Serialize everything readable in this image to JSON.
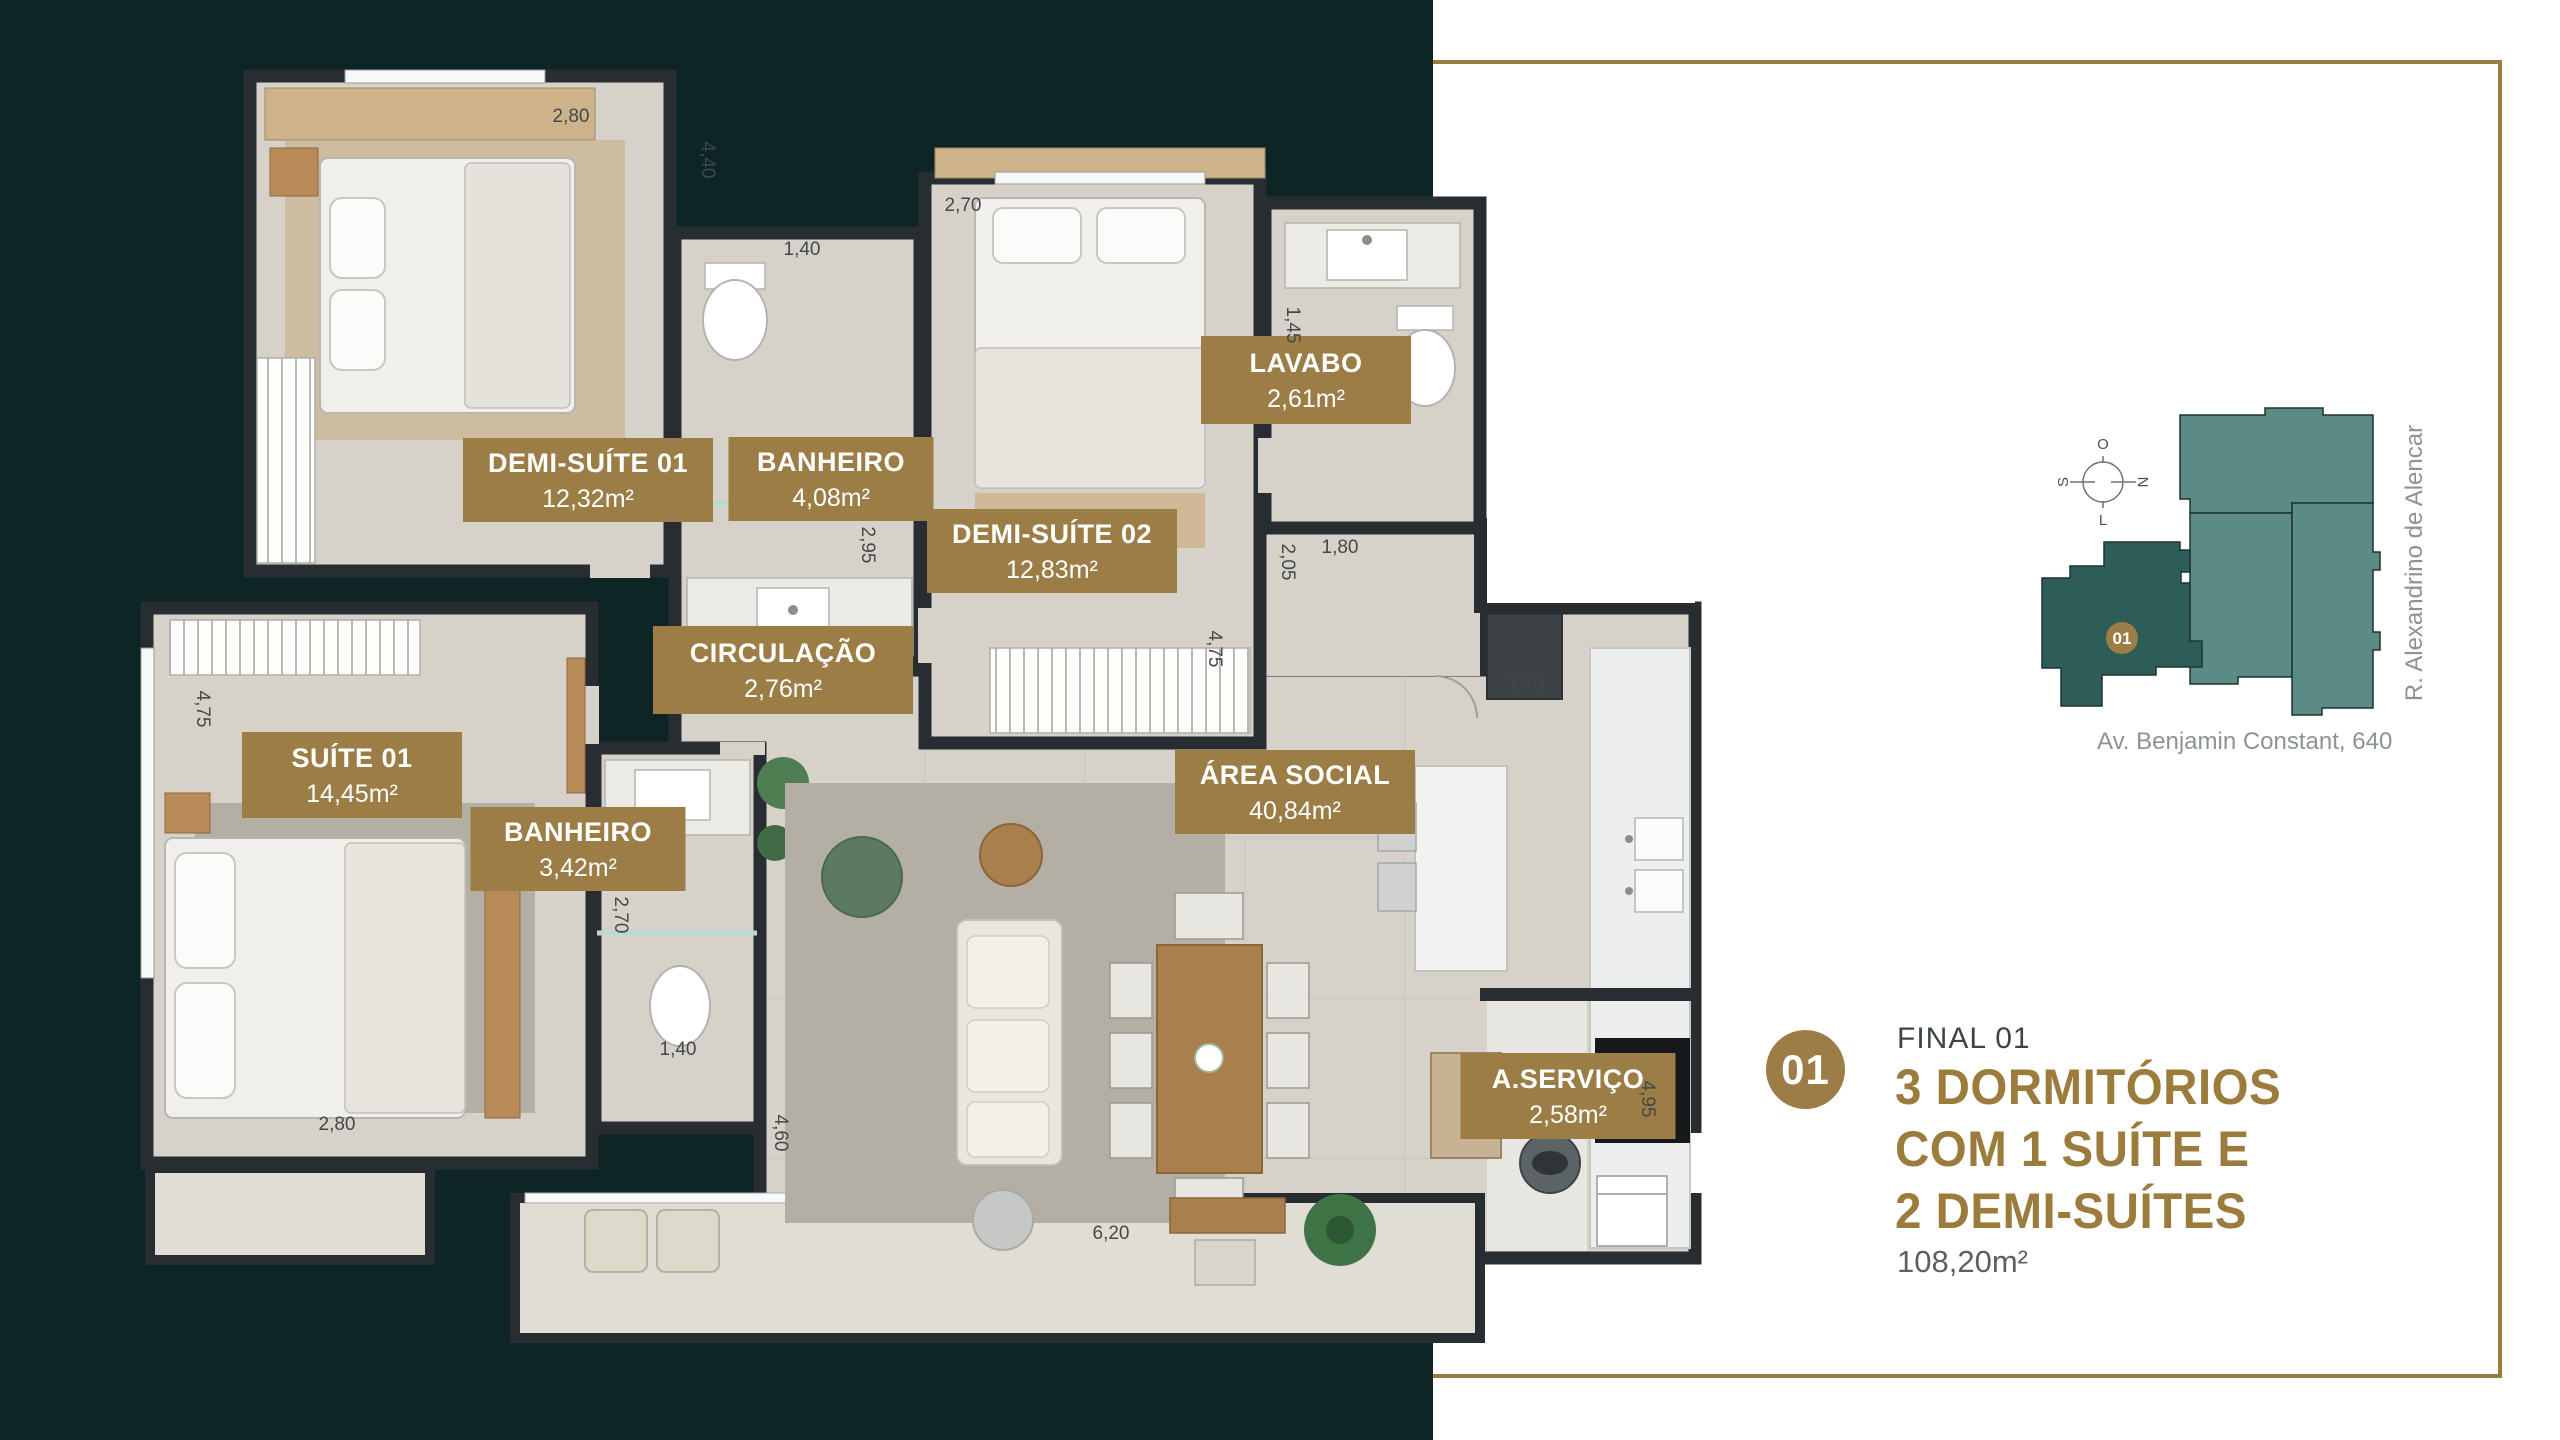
{
  "colors": {
    "teal_bg": "#0e2526",
    "gold": "#9b7d45",
    "gold_frame": "#997c40",
    "headline_gold": "#9c7c3c",
    "wall": "#272d31",
    "floor": "#d6d2c9",
    "terrace_floor": "#e0ddd5",
    "map_dark_unit": "#2e5c56",
    "map_light_unit": "#5c8a84"
  },
  "floor_plan": {
    "room_labels": [
      {
        "name": "DEMI-SUÍTE 01",
        "area": "12,32m²",
        "cx": 453,
        "cy": 432,
        "w": 250,
        "h": 84
      },
      {
        "name": "BANHEIRO",
        "area": "4,08m²",
        "cx": 696,
        "cy": 431,
        "w": 205,
        "h": 84
      },
      {
        "name": "LAVABO",
        "area": "2,61m²",
        "cx": 1171,
        "cy": 332,
        "w": 210,
        "h": 88
      },
      {
        "name": "DEMI-SUÍTE 02",
        "area": "12,83m²",
        "cx": 917,
        "cy": 503,
        "w": 250,
        "h": 84
      },
      {
        "name": "CIRCULAÇÃO",
        "area": "2,76m²",
        "cx": 648,
        "cy": 622,
        "w": 260,
        "h": 88
      },
      {
        "name": "SUÍTE 01",
        "area": "14,45m²",
        "cx": 217,
        "cy": 727,
        "w": 220,
        "h": 86
      },
      {
        "name": "BANHEIRO",
        "area": "3,42m²",
        "cx": 443,
        "cy": 801,
        "w": 215,
        "h": 84
      },
      {
        "name": "ÁREA SOCIAL",
        "area": "40,84m²",
        "cx": 1160,
        "cy": 744,
        "w": 240,
        "h": 84
      },
      {
        "name": "A.SERVIÇO",
        "area": "2,58m²",
        "cx": 1433,
        "cy": 1048,
        "w": 215,
        "h": 86
      }
    ],
    "dimensions": [
      {
        "t": "2,80",
        "x": 436,
        "y": 74
      },
      {
        "t": "4,40",
        "x": 567,
        "y": 112,
        "rot": 90
      },
      {
        "t": "1,40",
        "x": 667,
        "y": 207
      },
      {
        "t": "2,70",
        "x": 828,
        "y": 163
      },
      {
        "t": "1,45",
        "x": 1152,
        "y": 277,
        "rot": 90
      },
      {
        "t": "1,80",
        "x": 1205,
        "y": 505
      },
      {
        "t": "2,95",
        "x": 727,
        "y": 497,
        "rot": 90
      },
      {
        "t": "2,05",
        "x": 1147,
        "y": 514,
        "rot": 90
      },
      {
        "t": "4,75",
        "x": 1074,
        "y": 601,
        "rot": 90
      },
      {
        "t": "3,70",
        "x": 1390,
        "y": 642
      },
      {
        "t": "4,75",
        "x": 62,
        "y": 661,
        "rot": 90
      },
      {
        "t": "2,70",
        "x": 480,
        "y": 867,
        "rot": 90
      },
      {
        "t": "1,40",
        "x": 543,
        "y": 1007
      },
      {
        "t": "2,80",
        "x": 202,
        "y": 1082
      },
      {
        "t": "4,60",
        "x": 640,
        "y": 1085,
        "rot": 90
      },
      {
        "t": "6,20",
        "x": 976,
        "y": 1191
      },
      {
        "t": "4,95",
        "x": 1507,
        "y": 1051,
        "rot": 90
      }
    ]
  },
  "site_map": {
    "compass": {
      "top": "O",
      "right": "N",
      "bottom": "L",
      "left": "S"
    },
    "unit_marker": "01",
    "street_right": "R. Alexandrino de Alencar",
    "street_bottom": "Av. Benjamin Constant, 640"
  },
  "info_panel": {
    "badge": "01",
    "final_label": "FINAL 01",
    "headline_lines": [
      "3 DORMITÓRIOS",
      "COM 1 SUÍTE E",
      "2 DEMI-SUÍTES"
    ],
    "total_area": "108,20m²"
  }
}
